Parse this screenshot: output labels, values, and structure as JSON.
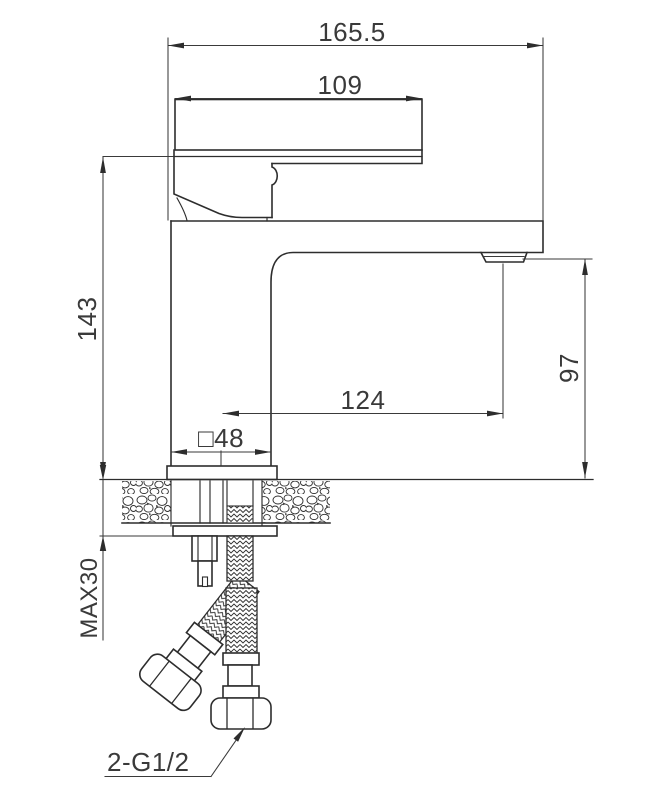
{
  "drawing": {
    "title": "basin-faucet-installation-technical-drawing",
    "dimensions": {
      "total_width": "165.5",
      "handle_length": "109",
      "height_above_counter": "143",
      "spout_height": "97",
      "spout_reach": "124",
      "base_square": "□48",
      "max_mounting_thickness": "MAX30",
      "hose_thread": "2-G1/2"
    },
    "colors": {
      "line": "#2d2d2d",
      "dimension": "#3a3a3a",
      "background": "#ffffff"
    }
  }
}
